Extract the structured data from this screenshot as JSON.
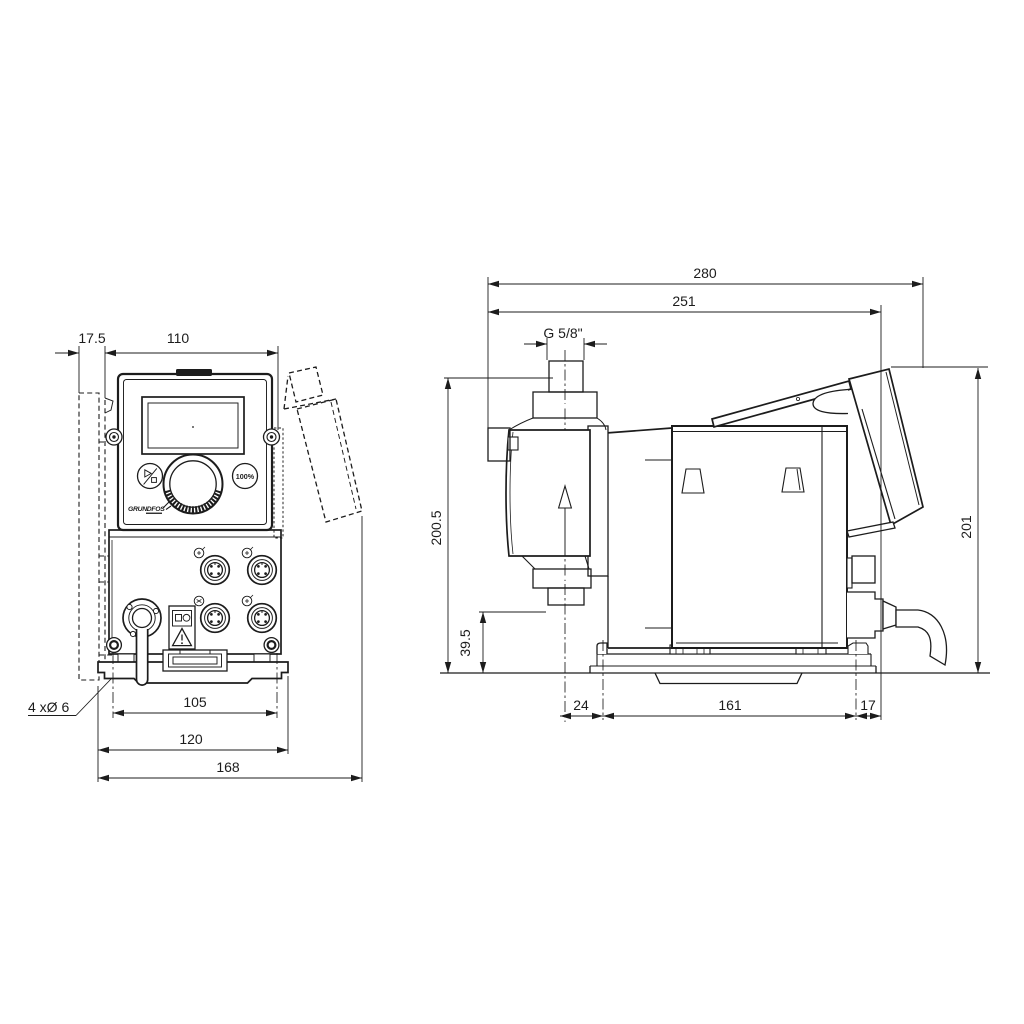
{
  "colors": {
    "line": "#1c1c1c",
    "background": "#ffffff"
  },
  "front_view": {
    "dims": {
      "wall_offset": "17.5",
      "panel_width": "110",
      "hole_spacing": "105",
      "plate_width": "120",
      "overall_width": "168"
    },
    "holes_note": "4 xØ 6",
    "controls": {
      "capacity_button": "100%",
      "logo": "GRUNDFOS"
    },
    "icons": {
      "start_stop": "play-stop-icon",
      "warning": "warning-triangle-icon",
      "connectors": "m12-connector-icon"
    }
  },
  "side_view": {
    "dims": {
      "overall_depth": "280",
      "body_depth": "251",
      "thread": "G 5/8\"",
      "height_over_inlet": "200.5",
      "outlet_height": "39.5",
      "front_offset": "24",
      "foot_length": "161",
      "rear_offset": "17",
      "overall_height": "201"
    },
    "icons": {
      "flow_direction": "up-arrow-icon"
    }
  }
}
